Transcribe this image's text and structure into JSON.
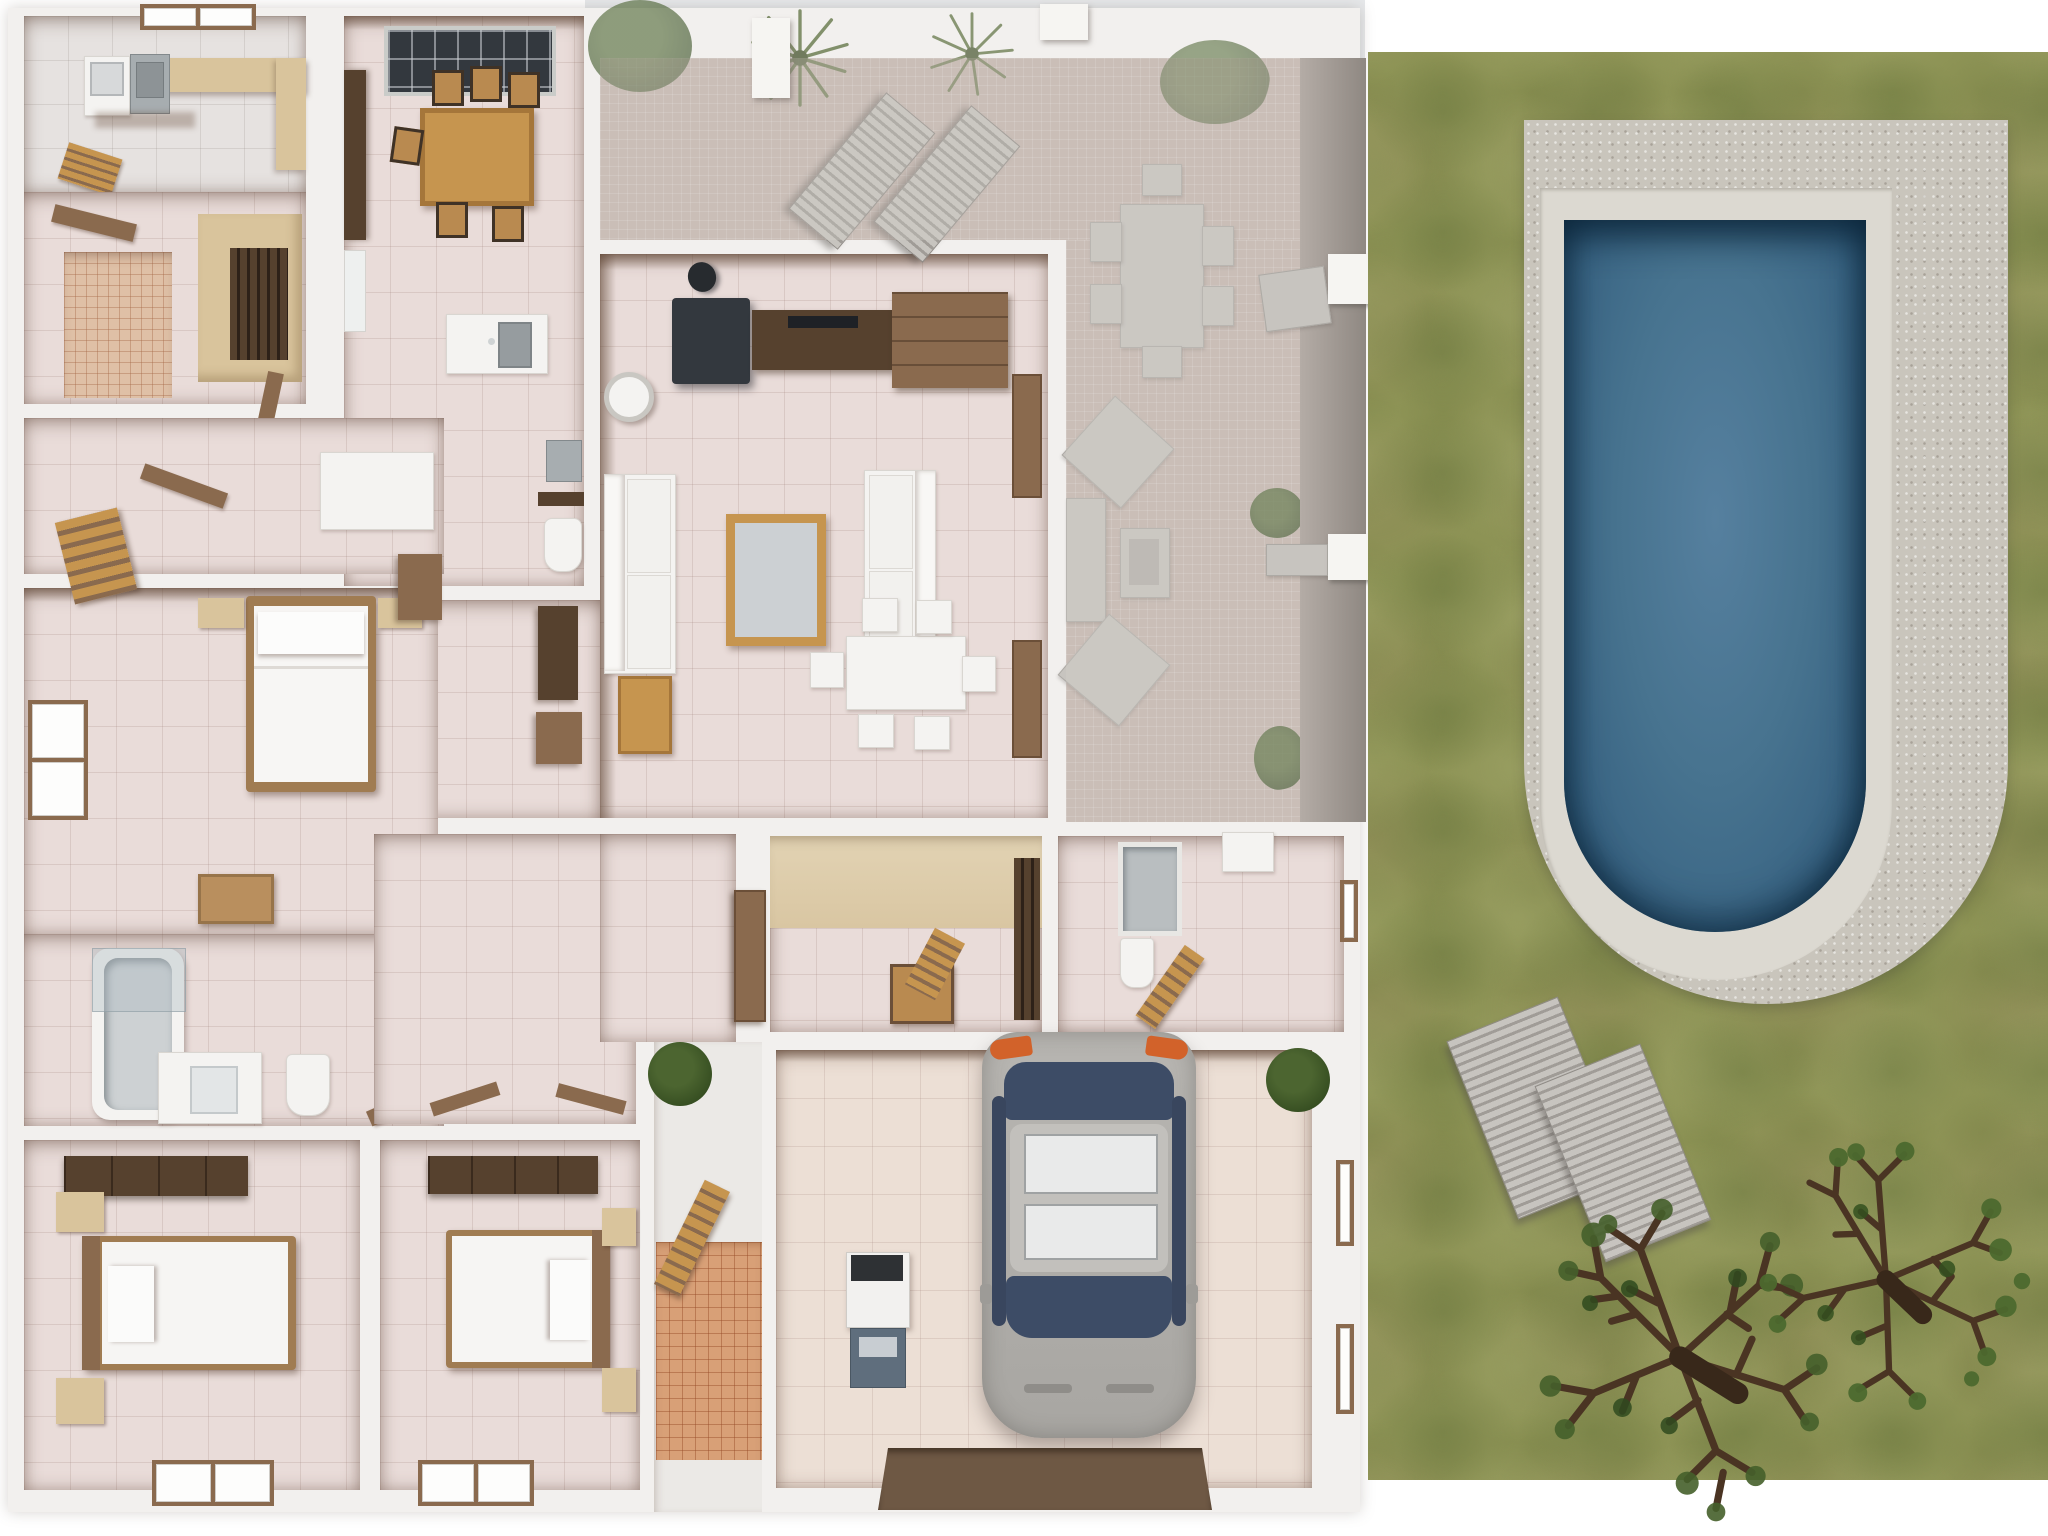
{
  "scene": {
    "type": "3d-floor-plan-top-down-render",
    "description": "Overhead 3D render of a single-storey furnished house with covered patio, garage with parked car, and lawn with U-shaped swimming pool, two sun loungers and two trees"
  },
  "colors": {
    "background": "#ffffff",
    "sky": "#e7e9eb",
    "wall": "#f2f0ee",
    "wall_shadow": "#c9c4bf",
    "tile": "#e9dcd9",
    "tile_gray": "#e6e2e0",
    "tile_garage": "#ecdfd5",
    "mosaic": "#dfc0a6",
    "terracotta": "#d8a077",
    "patio": "#c6b6af",
    "patio_wall": "#a39c96",
    "outdoor_gray": "#c7c4bf",
    "wood": "#8a6a4e",
    "wood_dark": "#56412e",
    "wood_light": "#c6954f",
    "beige": "#d9c49c",
    "beige_wall": "#e2d3b4",
    "stove": "#33383e",
    "white_furn": "#f4f3f1",
    "steel": "#a7adb0",
    "grass": "#8d9355",
    "stone": "#c9c5bc",
    "coping": "#dcd9d1",
    "water": "#47738f",
    "water_deep": "#2c5573",
    "car_silver": "#b7b5b1",
    "car_glass": "#3d4c66",
    "taillight": "#d2622a",
    "mat": "#6e5844",
    "plant": "#4c6530",
    "plant_dark": "#344c20"
  },
  "inventory": {
    "indoor_areas": [
      {
        "id": "utility-room",
        "objects": [
          "washing-machine",
          "steel-sink",
          "counter",
          "roof-window",
          "wood-rack"
        ]
      },
      {
        "id": "small-bathroom",
        "objects": [
          "mosaic-floor",
          "wood-door"
        ]
      },
      {
        "id": "closet",
        "objects": [
          "slatted-wardrobe"
        ]
      },
      {
        "id": "kitchen",
        "objects": [
          "skylight",
          "dining-table",
          "chairs-x6",
          "sink-counter",
          "wall-cabinet"
        ]
      },
      {
        "id": "living-room",
        "objects": [
          "wood-stove",
          "tv-console",
          "cabinet",
          "sofa-x2",
          "coffee-table",
          "side-table",
          "floor-lamp",
          "dining-table-white",
          "chairs-x6",
          "wall-panels"
        ]
      },
      {
        "id": "master-bedroom",
        "objects": [
          "double-bed",
          "nightstand-x2",
          "dresser",
          "window",
          "chest",
          "plant",
          "valet-chair"
        ]
      },
      {
        "id": "hall",
        "objects": [
          "white-cabinet",
          "doors"
        ]
      },
      {
        "id": "pantry-wc",
        "objects": [
          "sink",
          "shelf",
          "toilet",
          "cabinets"
        ]
      },
      {
        "id": "bathroom",
        "objects": [
          "bathtub",
          "shower-screen",
          "vanity-sink",
          "toilet",
          "door"
        ]
      },
      {
        "id": "bedroom-left",
        "objects": [
          "wardrobe",
          "double-bed",
          "nightstand-x2",
          "floor-window"
        ]
      },
      {
        "id": "bedroom-right",
        "objects": [
          "wardrobe",
          "double-bed",
          "nightstand-x2",
          "floor-window"
        ]
      },
      {
        "id": "vestibule",
        "objects": [
          "beige-wall",
          "slat-door",
          "wood-chair"
        ]
      },
      {
        "id": "rear-bathroom",
        "objects": [
          "shower",
          "toilet",
          "sink",
          "door-leaf",
          "window"
        ]
      },
      {
        "id": "entry-walkway",
        "objects": [
          "plant",
          "terracotta-path",
          "front-door"
        ]
      },
      {
        "id": "garage",
        "objects": [
          "car",
          "water-heater",
          "door-mat",
          "window-x2",
          "plant"
        ]
      }
    ],
    "outdoor_areas": [
      {
        "id": "covered-patio",
        "objects": [
          "palm-x2",
          "loungers-x2",
          "dining-table",
          "chairs-x6",
          "lounge-set",
          "plants-x2",
          "pergola-pillars-x2"
        ]
      },
      {
        "id": "lawn",
        "objects": [
          "pool",
          "pool-deck",
          "sun-lounger-x2",
          "tree-x2"
        ]
      }
    ],
    "counts": {
      "patio_dining_chairs": 6,
      "kitchen_chairs": 6,
      "indoor_dining_chairs": 6,
      "lawn_sun_loungers": 2,
      "patio_loungers": 2,
      "trees": 2,
      "cars": 1
    }
  }
}
